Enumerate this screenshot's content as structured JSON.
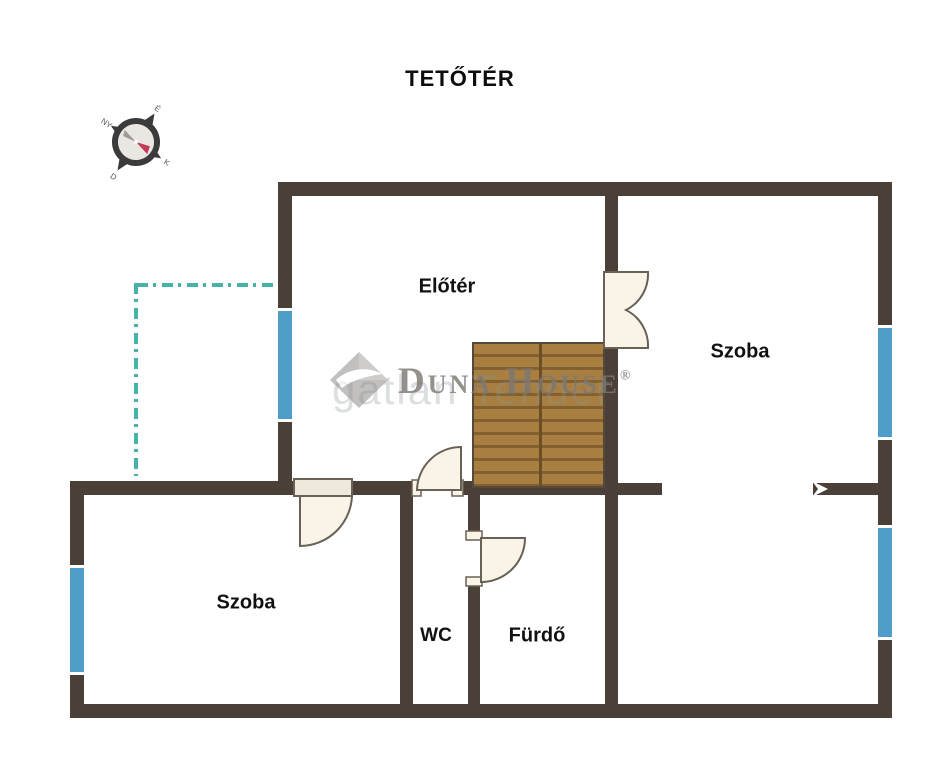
{
  "title": "TETŐTÉR",
  "compass": {
    "labels": {
      "n": "É",
      "e": "K",
      "s": "D",
      "w": "NY"
    }
  },
  "rooms": {
    "eloter": {
      "label": "Előtér"
    },
    "szoba_right": {
      "label": "Szoba"
    },
    "szoba_left": {
      "label": "Szoba"
    },
    "wc": {
      "label": "WC"
    },
    "furdo": {
      "label": "Fürdő"
    }
  },
  "watermark": {
    "brand": "Duna House",
    "registered": "®",
    "background_text": "gatlan Tender"
  },
  "colors": {
    "wall": "#4a4038",
    "window_blue": "#4f9dc8",
    "door_cream": "#f9f3e8",
    "door_outline": "#6a6156",
    "stairs_wood": "#a87e41",
    "stairs_line": "#83602f",
    "annotation_teal": "#45b3a5",
    "compass_needle_red": "#c23b57",
    "compass_needle_gray": "#9b9b9b",
    "label_text": "#111111"
  }
}
